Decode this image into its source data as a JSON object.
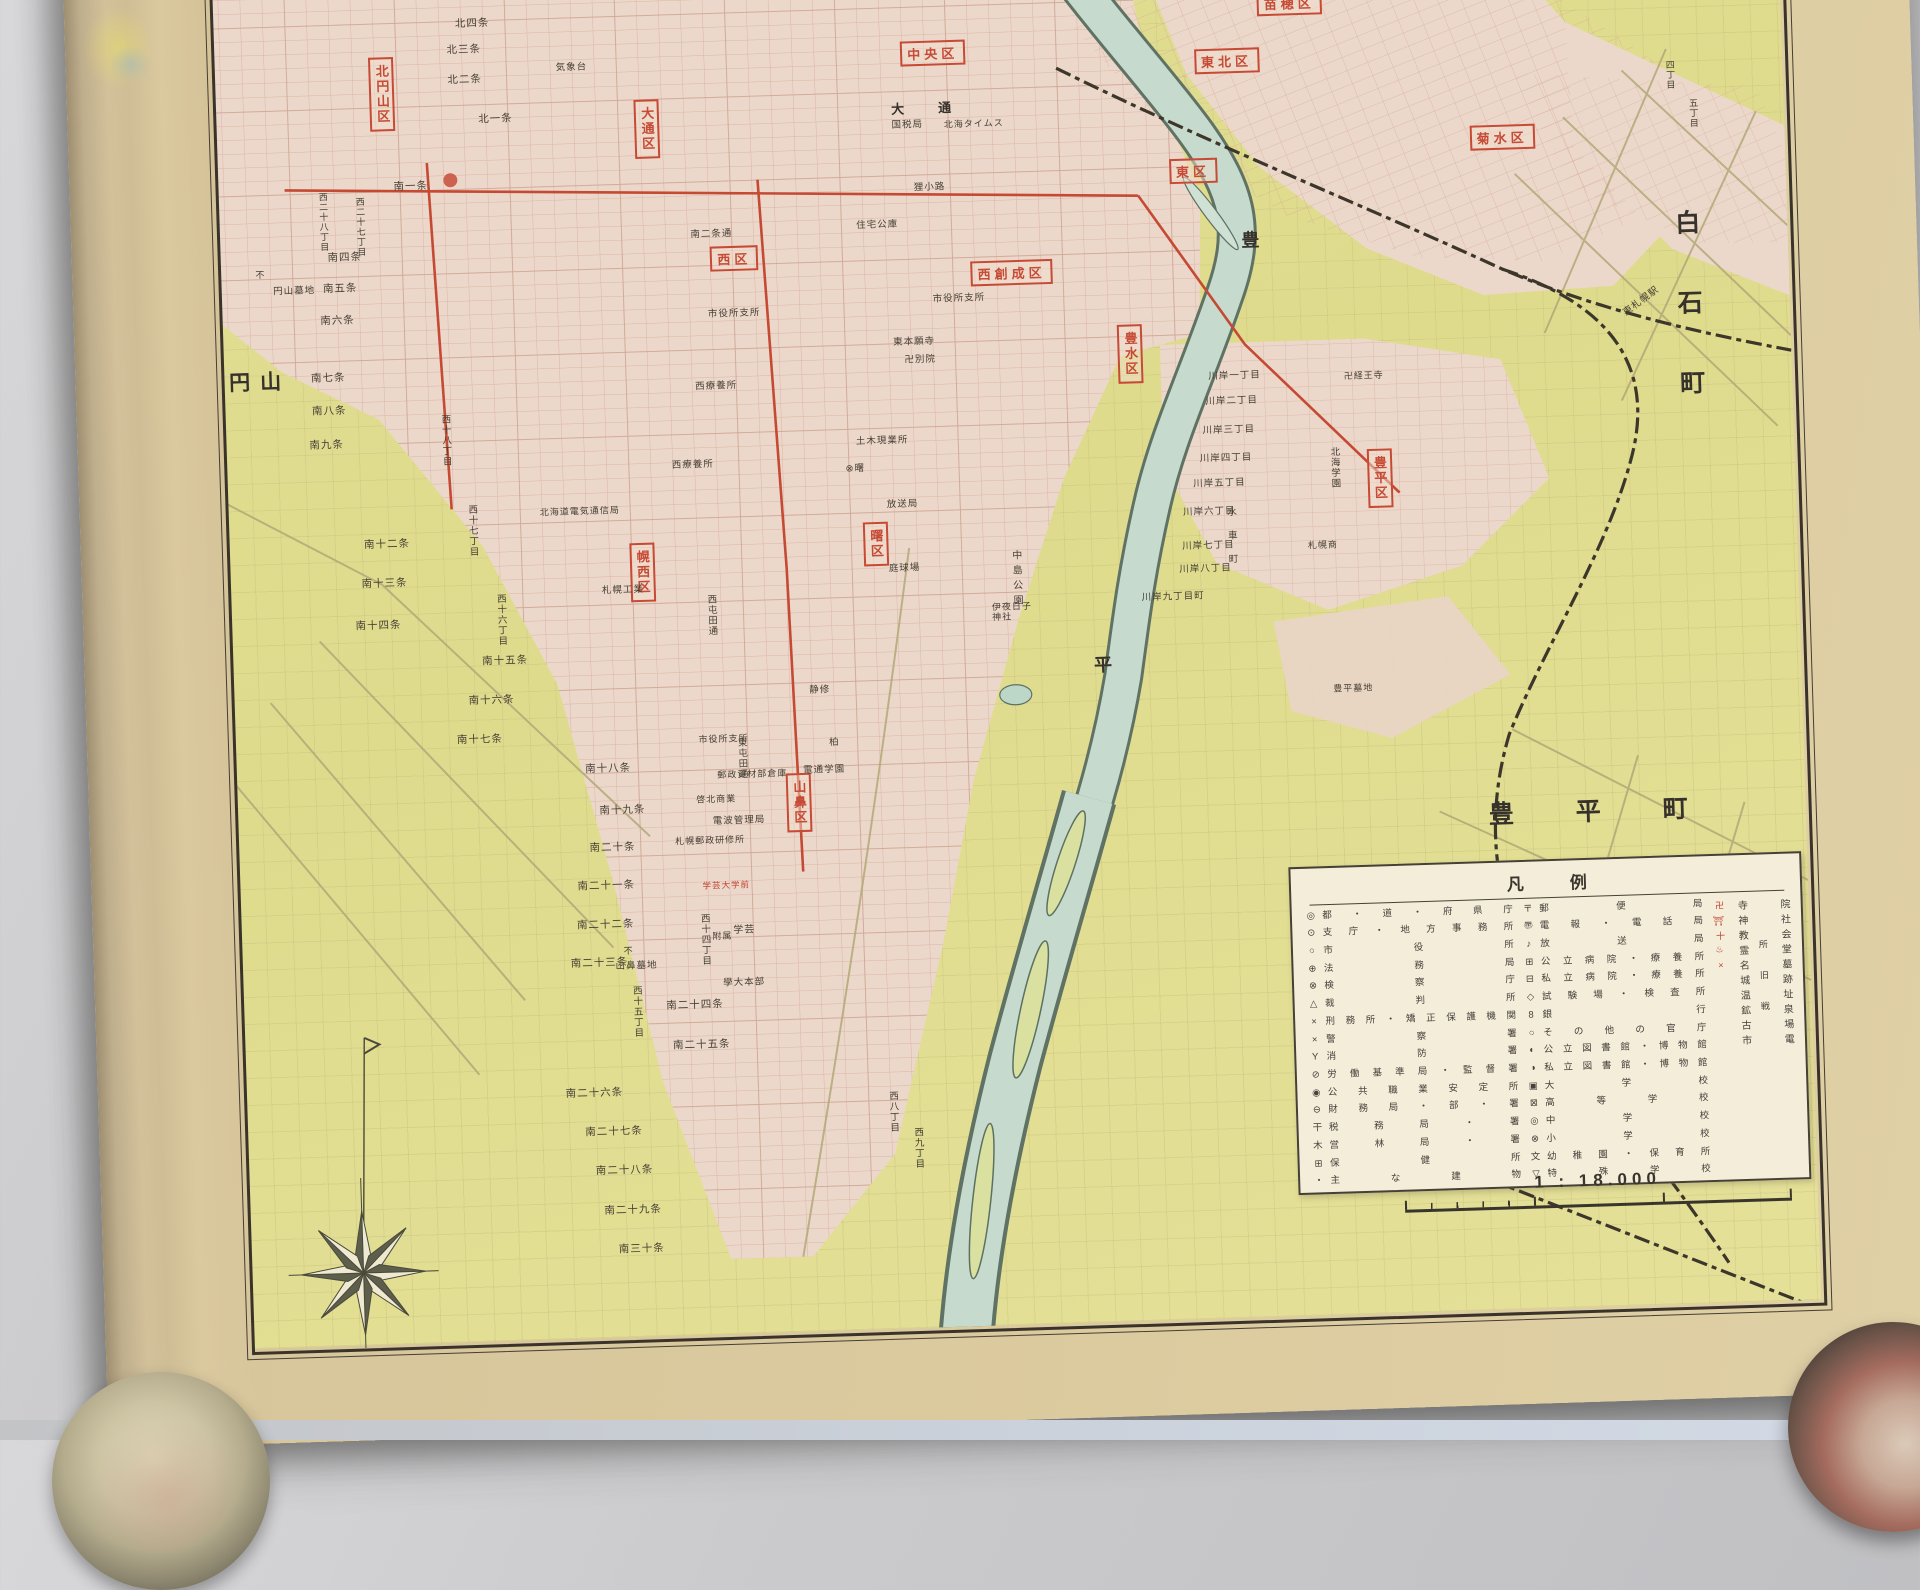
{
  "palette": {
    "paper_margin": "#d8c69c",
    "map_ground": "#e0dc8f",
    "urban_pink": "#ecd8cb",
    "river": "#c6dbcd",
    "accent_red": "#c64a35",
    "ink": "#443e33",
    "legend_bg": "#f3edda"
  },
  "districts": [
    {
      "t": "北円山区",
      "x": 17.1,
      "y": 10.3,
      "v": true
    },
    {
      "t": "大通区",
      "x": 31.4,
      "y": 13.2,
      "v": true
    },
    {
      "t": "中央区",
      "x": 47.0,
      "y": 8.7
    },
    {
      "t": "東北区",
      "x": 62.9,
      "y": 9.9
    },
    {
      "t": "苗穂区",
      "x": 66.4,
      "y": 6.1
    },
    {
      "t": "東区",
      "x": 60.9,
      "y": 17.1
    },
    {
      "t": "菊水区",
      "x": 77.7,
      "y": 15.5
    },
    {
      "t": "西区",
      "x": 35.9,
      "y": 22.0
    },
    {
      "t": "西創成区",
      "x": 50.9,
      "y": 23.5
    },
    {
      "t": "豊水区",
      "x": 57.2,
      "y": 29.2,
      "v": true
    },
    {
      "t": "曙区",
      "x": 43.1,
      "y": 41.3,
      "v": true
    },
    {
      "t": "幌西区",
      "x": 30.4,
      "y": 42.7,
      "v": true
    },
    {
      "t": "山鼻区",
      "x": 38.5,
      "y": 58.4,
      "v": true
    },
    {
      "t": "豊平区",
      "x": 70.5,
      "y": 38.0,
      "v": true
    }
  ],
  "areas": [
    {
      "t": "円山",
      "x": 10.0,
      "y": 29.2,
      "fs": 21,
      "ls": 10
    },
    {
      "t": "白石町",
      "x": 87.5,
      "y": 28.7,
      "v": true,
      "fs": 25,
      "ls": 55
    },
    {
      "t": "豊平町",
      "x": 82.9,
      "y": 60.5,
      "fs": 25,
      "ls": 62
    },
    {
      "t": "豊",
      "x": 64.1,
      "y": 21.8,
      "fs": 18
    },
    {
      "t": "平",
      "x": 55.4,
      "y": 49.8,
      "fs": 18
    },
    {
      "t": "大通",
      "x": 47.2,
      "y": 12.3,
      "fs": 13,
      "ls": 34
    }
  ],
  "streets": [
    {
      "t": "北四条",
      "x": 22.1,
      "y": 5.8
    },
    {
      "t": "北三条",
      "x": 21.6,
      "y": 7.5
    },
    {
      "t": "北二条",
      "x": 21.6,
      "y": 9.5
    },
    {
      "t": "北一条",
      "x": 23.2,
      "y": 12.2
    },
    {
      "t": "南一条",
      "x": 18.5,
      "y": 16.5
    },
    {
      "t": "南四条",
      "x": 14.8,
      "y": 21.1
    },
    {
      "t": "南五条",
      "x": 14.5,
      "y": 23.2
    },
    {
      "t": "南六条",
      "x": 14.3,
      "y": 25.3
    },
    {
      "t": "南七条",
      "x": 13.7,
      "y": 29.1
    },
    {
      "t": "南八条",
      "x": 13.7,
      "y": 31.3
    },
    {
      "t": "南九条",
      "x": 13.5,
      "y": 33.6
    },
    {
      "t": "南十二条",
      "x": 16.6,
      "y": 40.3
    },
    {
      "t": "南十三条",
      "x": 16.4,
      "y": 42.9
    },
    {
      "t": "南十四条",
      "x": 16.0,
      "y": 45.7
    },
    {
      "t": "南十五条",
      "x": 22.8,
      "y": 48.3
    },
    {
      "t": "南十六条",
      "x": 22.0,
      "y": 50.9
    },
    {
      "t": "南十七条",
      "x": 21.3,
      "y": 53.5
    },
    {
      "t": "南十八条",
      "x": 28.2,
      "y": 55.7
    },
    {
      "t": "南十九条",
      "x": 28.9,
      "y": 58.5
    },
    {
      "t": "南二十条",
      "x": 28.3,
      "y": 61.0
    },
    {
      "t": "南二十一条",
      "x": 27.9,
      "y": 63.5
    },
    {
      "t": "南二十二条",
      "x": 27.8,
      "y": 66.1
    },
    {
      "t": "南二十三条",
      "x": 27.4,
      "y": 68.7
    },
    {
      "t": "南二十四条",
      "x": 32.5,
      "y": 71.7
    },
    {
      "t": "南二十五条",
      "x": 32.8,
      "y": 74.3
    },
    {
      "t": "南二十六条",
      "x": 26.9,
      "y": 77.3
    },
    {
      "t": "南二十七条",
      "x": 27.9,
      "y": 79.9
    },
    {
      "t": "南二十八条",
      "x": 28.4,
      "y": 82.5
    },
    {
      "t": "南二十九条",
      "x": 28.8,
      "y": 85.2
    },
    {
      "t": "南三十条",
      "x": 29.2,
      "y": 87.8
    },
    {
      "t": "西二十八丁目",
      "x": 13.7,
      "y": 18.7,
      "v": true,
      "fs": 9
    },
    {
      "t": "西二十七丁目",
      "x": 15.7,
      "y": 19.1,
      "v": true,
      "fs": 9
    },
    {
      "t": "西十八丁目",
      "x": 19.9,
      "y": 33.5,
      "v": true,
      "fs": 9.5
    },
    {
      "t": "西十七丁目",
      "x": 21.2,
      "y": 39.6,
      "v": true,
      "fs": 9.5
    },
    {
      "t": "西十六丁目",
      "x": 22.6,
      "y": 45.6,
      "v": true,
      "fs": 9.5
    },
    {
      "t": "西十五丁目",
      "x": 29.3,
      "y": 72.0,
      "v": true,
      "fs": 9.5
    },
    {
      "t": "西十四丁目",
      "x": 33.1,
      "y": 67.3,
      "v": true,
      "fs": 9.5
    },
    {
      "t": "西八丁目",
      "x": 43.0,
      "y": 79.2,
      "v": true,
      "fs": 9.5
    },
    {
      "t": "西九丁目",
      "x": 44.3,
      "y": 81.7,
      "v": true,
      "fs": 9.5
    },
    {
      "t": "四丁目",
      "x": 86.9,
      "y": 11.7,
      "v": true,
      "fs": 9
    },
    {
      "t": "五丁目",
      "x": 88.1,
      "y": 14.3,
      "v": true,
      "fs": 9
    },
    {
      "t": "川岸一丁目",
      "x": 62.8,
      "y": 30.9,
      "fs": 9.5
    },
    {
      "t": "川岸二丁目",
      "x": 62.6,
      "y": 32.6,
      "fs": 9.5
    },
    {
      "t": "川岸三丁目",
      "x": 62.4,
      "y": 34.5,
      "fs": 9.5
    },
    {
      "t": "川岸四丁目",
      "x": 62.2,
      "y": 36.4,
      "fs": 9.5
    },
    {
      "t": "川岸五丁目",
      "x": 61.8,
      "y": 38.1,
      "fs": 9.5
    },
    {
      "t": "川岸六丁目",
      "x": 61.2,
      "y": 39.9,
      "fs": 9.5
    },
    {
      "t": "川岸七丁目",
      "x": 61.1,
      "y": 42.2,
      "fs": 9.5
    },
    {
      "t": "川岸八丁目",
      "x": 60.9,
      "y": 43.7,
      "fs": 9.5
    },
    {
      "t": "川岸九丁目町",
      "x": 59.1,
      "y": 45.5,
      "fs": 9.5
    },
    {
      "t": "水車町",
      "x": 62.3,
      "y": 41.9,
      "v": true,
      "fs": 9.5,
      "ls": 14
    }
  ],
  "landmarks": [
    {
      "t": "気象台",
      "x": 27.4,
      "y": 9.0,
      "fs": 9.5
    },
    {
      "t": "国税局",
      "x": 45.5,
      "y": 13.5,
      "fs": 9.5
    },
    {
      "t": "北海タイムス",
      "x": 49.1,
      "y": 13.5,
      "fs": 9
    },
    {
      "t": "狸小路",
      "x": 46.6,
      "y": 17.7,
      "fs": 9.5
    },
    {
      "t": "住宅公庫",
      "x": 43.7,
      "y": 20.1,
      "fs": 9.5
    },
    {
      "t": "南二条通",
      "x": 34.7,
      "y": 20.4,
      "fs": 9.5
    },
    {
      "t": "市役所支所",
      "x": 35.8,
      "y": 25.7,
      "fs": 9.5
    },
    {
      "t": "市役所支所",
      "x": 48.0,
      "y": 25.2,
      "fs": 9.5
    },
    {
      "t": "東本願寺",
      "x": 45.5,
      "y": 28.0,
      "fs": 9.5
    },
    {
      "t": "卍別院",
      "x": 45.8,
      "y": 29.2,
      "fs": 9.5
    },
    {
      "t": "西療養所",
      "x": 34.7,
      "y": 30.5,
      "fs": 9.5
    },
    {
      "t": "西療養所",
      "x": 33.3,
      "y": 35.7,
      "fs": 9.5
    },
    {
      "t": "土木現業所",
      "x": 43.6,
      "y": 34.5,
      "fs": 9.5
    },
    {
      "t": "⊗曙",
      "x": 42.1,
      "y": 36.3,
      "fs": 9.5
    },
    {
      "t": "北海道電気通信局",
      "x": 27.1,
      "y": 38.5,
      "fs": 9
    },
    {
      "t": "札幌工業",
      "x": 29.3,
      "y": 43.9,
      "fs": 9.5
    },
    {
      "t": "放送局",
      "x": 44.6,
      "y": 38.8,
      "fs": 9.5
    },
    {
      "t": "庭球場",
      "x": 44.6,
      "y": 43.1,
      "fs": 9.5
    },
    {
      "t": "中島公園",
      "x": 50.6,
      "y": 44.0,
      "v": true,
      "fs": 10,
      "ls": 5
    },
    {
      "t": "伊夜日子神社",
      "x": 50.4,
      "y": 46.1,
      "fs": 9,
      "w": 42
    },
    {
      "t": "静修",
      "x": 39.8,
      "y": 51.0,
      "fs": 9.5
    },
    {
      "t": "西屯田通",
      "x": 34.0,
      "y": 45.7,
      "v": true,
      "fs": 9.5
    },
    {
      "t": "東屯田通",
      "x": 35.4,
      "y": 55.3,
      "v": true,
      "fs": 9.5
    },
    {
      "t": "市役所支所",
      "x": 34.5,
      "y": 54.0,
      "fs": 9
    },
    {
      "t": "電波管理局",
      "x": 35.2,
      "y": 59.5,
      "fs": 9.5
    },
    {
      "t": "札幌郵政研修所",
      "x": 33.6,
      "y": 60.7,
      "fs": 9
    },
    {
      "t": "郵政資材部倉庫",
      "x": 36.0,
      "y": 56.4,
      "fs": 9
    },
    {
      "t": "電通学園",
      "x": 39.9,
      "y": 56.3,
      "fs": 9.5
    },
    {
      "t": "柏",
      "x": 40.5,
      "y": 54.5,
      "fs": 9.5
    },
    {
      "t": "啓北商業",
      "x": 34.0,
      "y": 58.0,
      "fs": 9
    },
    {
      "t": "學大本部",
      "x": 35.2,
      "y": 70.3,
      "fs": 9.5
    },
    {
      "t": "学芸",
      "x": 35.3,
      "y": 66.8,
      "fs": 10
    },
    {
      "t": "附属",
      "x": 34.1,
      "y": 67.1,
      "fs": 9
    },
    {
      "t": "不",
      "x": 29.0,
      "y": 67.9,
      "fs": 9
    },
    {
      "t": "山鼻墓地",
      "x": 29.4,
      "y": 69.0,
      "fs": 9.5
    },
    {
      "t": "不",
      "x": 10.2,
      "y": 22.1,
      "fs": 9
    },
    {
      "t": "円山墓地",
      "x": 12.0,
      "y": 23.3,
      "fs": 9.5
    },
    {
      "t": "東札幌駅",
      "x": 85.0,
      "y": 26.8,
      "fs": 9.5,
      "rot": -35
    },
    {
      "t": "卍経王寺",
      "x": 69.8,
      "y": 31.1,
      "fs": 9
    },
    {
      "t": "北海学園",
      "x": 68.0,
      "y": 37.2,
      "v": true,
      "fs": 9.5
    },
    {
      "t": "札幌商",
      "x": 67.3,
      "y": 42.3,
      "fs": 9
    },
    {
      "t": "豊平墓地",
      "x": 68.7,
      "y": 51.9,
      "fs": 9
    },
    {
      "t": "学芸大学前",
      "x": 34.4,
      "y": 63.8,
      "fs": 8.5,
      "cls": "red"
    }
  ],
  "legend": {
    "title": "凡例",
    "col1": [
      {
        "sym": "◎",
        "label": "都・道・府県庁"
      },
      {
        "sym": "⊙",
        "label": "支庁・地方事務所"
      },
      {
        "sym": "○",
        "label": "市役所"
      },
      {
        "sym": "⊕",
        "label": "法務局"
      },
      {
        "sym": "⊗",
        "label": "検察庁"
      },
      {
        "sym": "△",
        "label": "裁判所"
      },
      {
        "sym": "×",
        "label": "刑務所・矯正保護機関"
      },
      {
        "sym": "×",
        "label": "警察署"
      },
      {
        "sym": "Y",
        "label": "消防署"
      },
      {
        "sym": "⊘",
        "label": "労働基準局・監督署"
      },
      {
        "sym": "◉",
        "label": "公共職業安定所"
      },
      {
        "sym": "⊖",
        "label": "財務局・部・署"
      },
      {
        "sym": "干",
        "label": "税務局・署"
      },
      {
        "sym": "木",
        "label": "営林局・署"
      },
      {
        "sym": "⊞",
        "label": "保健所"
      },
      {
        "sym": "・",
        "label": "主な建物"
      }
    ],
    "col2": [
      {
        "sym": "〒",
        "label": "郵便局"
      },
      {
        "sym": "〠",
        "label": "電報・電話局"
      },
      {
        "sym": "♪",
        "label": "放送局"
      },
      {
        "sym": "⊞",
        "label": "公立病院・療養所"
      },
      {
        "sym": "⊟",
        "label": "私立病院・療養所"
      },
      {
        "sym": "◇",
        "label": "試験場・検査所"
      },
      {
        "sym": "8",
        "label": "銀行"
      },
      {
        "sym": "○",
        "label": "その他の官庁"
      },
      {
        "sym": "◐",
        "label": "公立図書館・博物館"
      },
      {
        "sym": "◑",
        "label": "私立図書館・博物館"
      },
      {
        "sym": "▣",
        "label": "大学校"
      },
      {
        "sym": "⊠",
        "label": "高等学校"
      },
      {
        "sym": "◎",
        "label": "中学校"
      },
      {
        "sym": "⊗",
        "label": "小学校"
      },
      {
        "sym": "文",
        "label": "幼稚園・保育所"
      },
      {
        "sym": "▽",
        "label": "特殊学校"
      }
    ],
    "right_symbols": "卍⛩十♨×",
    "right_col_a": "寺神教霊名城温鉱古市",
    "right_col_mid": "所旧戦",
    "right_col_b": "院社会堂墓跡址泉場電",
    "scale_ratio": "1 : 18.000",
    "scale_ticks": [
      "0",
      "100",
      "200",
      "300m"
    ]
  },
  "compass": {
    "name": "compass-rose"
  }
}
